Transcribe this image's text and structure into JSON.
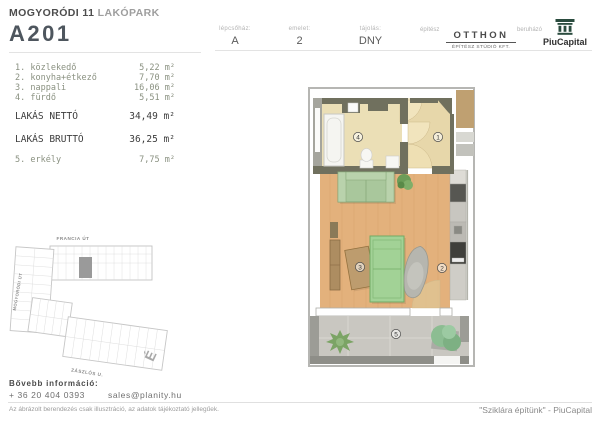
{
  "header": {
    "project_bold": "MOGYORÓDI 11",
    "project_light": "LAKÓPARK",
    "unit_id": "A201",
    "meta": [
      {
        "label": "lépcsőház:",
        "value": "A"
      },
      {
        "label": "emelet:",
        "value": "2"
      },
      {
        "label": "tájolás:",
        "value": "DNY"
      }
    ],
    "architect_label": "építész",
    "architect_logo_main": "OTTHON",
    "architect_logo_sub": "ÉPÍTÉSZ STÚDIÓ KFT.",
    "developer_label": "beruházó",
    "developer_logo": "PiuCapital"
  },
  "room_list": {
    "rooms": [
      {
        "name": "1. közlekedő",
        "area": "5,22 m²"
      },
      {
        "name": "2. konyha+étkező",
        "area": "7,70 m²"
      },
      {
        "name": "3. nappali",
        "area": "16,06 m²"
      },
      {
        "name": "4. fürdő",
        "area": "5,51 m²"
      }
    ],
    "totals": [
      {
        "label": "LAKÁS NETTÓ",
        "value": "34,49 m²"
      },
      {
        "label": "LAKÁS BRUTTÓ",
        "value": "36,25 m²"
      }
    ],
    "outdoor": {
      "name": "5. erkély",
      "area": "7,75 m²"
    }
  },
  "site_plan": {
    "street_top": "FRANCIA ÚT",
    "street_left": "MOGYORÓDI ÚT",
    "street_bottom": "ZÁSZLÓS U.",
    "north_label": "É"
  },
  "floor_plan": {
    "room_labels": [
      "1",
      "2",
      "3",
      "4",
      "5"
    ]
  },
  "footer": {
    "info_label": "Bővebb információ:",
    "phone": "+ 36 20 404 0393",
    "email": "sales@planity.hu",
    "disclaimer": "Az ábrázolt berendezés csak illusztráció, az adatok tájékoztató jellegűek.",
    "slogan": "\"Sziklára építünk\" - PiuCapital"
  },
  "colors": {
    "accent_dark": "#4e565e",
    "wall": "#70705e",
    "wood_floor": "#e3b17c",
    "bath_floor": "#ebdfb6",
    "hall_floor": "#e7d7aa",
    "balcony_floor": "#c9c7c1",
    "furniture_green": "#a9c79c",
    "logo_green": "#2a4b3e"
  }
}
